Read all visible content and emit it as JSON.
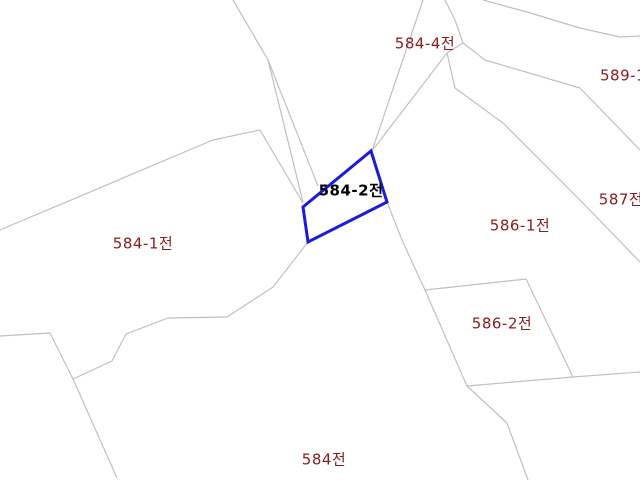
{
  "canvas": {
    "width": 640,
    "height": 480,
    "background": "#ffffff"
  },
  "map": {
    "type": "cadastral-parcel-map",
    "boundary_line_color": "#c0c0c0",
    "highlight_color": "#1b1bd9",
    "label_color": "#8b1a1a",
    "highlight_label_color": "#000000",
    "boundaries": [
      [
        [
          0,
          230
        ],
        [
          213,
          140
        ],
        [
          260,
          130
        ],
        [
          303,
          203
        ]
      ],
      [
        [
          233,
          0
        ],
        [
          268,
          60
        ],
        [
          303,
          202
        ]
      ],
      [
        [
          268,
          60
        ],
        [
          318,
          186
        ]
      ],
      [
        [
          423,
          0
        ],
        [
          372,
          151
        ]
      ],
      [
        [
          445,
          0
        ],
        [
          455,
          20
        ],
        [
          463,
          43
        ]
      ],
      [
        [
          463,
          43
        ],
        [
          447,
          53
        ]
      ],
      [
        [
          447,
          53
        ],
        [
          372,
          151
        ]
      ],
      [
        [
          447,
          53
        ],
        [
          455,
          88
        ],
        [
          503,
          123
        ],
        [
          580,
          200
        ],
        [
          640,
          262
        ]
      ],
      [
        [
          463,
          43
        ],
        [
          485,
          60
        ],
        [
          580,
          88
        ],
        [
          640,
          150
        ]
      ],
      [
        [
          483,
          0
        ],
        [
          527,
          12
        ],
        [
          580,
          28
        ],
        [
          620,
          37
        ],
        [
          640,
          36
        ]
      ],
      [
        [
          387,
          202
        ],
        [
          402,
          240
        ],
        [
          425,
          290
        ],
        [
          467,
          386
        ],
        [
          507,
          423
        ],
        [
          528,
          480
        ]
      ],
      [
        [
          425,
          290
        ],
        [
          526,
          279
        ]
      ],
      [
        [
          526,
          279
        ],
        [
          573,
          377
        ]
      ],
      [
        [
          467,
          386
        ],
        [
          573,
          377
        ],
        [
          640,
          372
        ]
      ],
      [
        [
          308,
          242
        ],
        [
          273,
          287
        ],
        [
          227,
          317
        ],
        [
          168,
          318
        ],
        [
          126,
          334
        ],
        [
          112,
          361
        ],
        [
          73,
          379
        ]
      ],
      [
        [
          0,
          336
        ],
        [
          50,
          333
        ],
        [
          73,
          379
        ],
        [
          117,
          478
        ]
      ]
    ],
    "highlighted_parcel": {
      "id": "584-2",
      "label": "584-2전",
      "points": [
        [
          371,
          151
        ],
        [
          387,
          202
        ],
        [
          308,
          242
        ],
        [
          303,
          207
        ]
      ]
    },
    "labels": [
      {
        "text": "584-4전",
        "x": 425,
        "y": 44,
        "anchor": "center",
        "highlighted": false
      },
      {
        "text": "589-1전",
        "x": 600,
        "y": 76,
        "anchor": "left",
        "highlighted": false
      },
      {
        "text": "587전",
        "x": 621,
        "y": 200,
        "anchor": "center",
        "highlighted": false
      },
      {
        "text": "586-1전",
        "x": 520,
        "y": 226,
        "anchor": "center",
        "highlighted": false
      },
      {
        "text": "586-2전",
        "x": 502,
        "y": 324,
        "anchor": "center",
        "highlighted": false
      },
      {
        "text": "584-1전",
        "x": 143,
        "y": 244,
        "anchor": "center",
        "highlighted": false
      },
      {
        "text": "584전",
        "x": 324,
        "y": 460,
        "anchor": "center",
        "highlighted": false
      },
      {
        "text": "584-2전",
        "x": 351,
        "y": 191,
        "anchor": "center",
        "highlighted": true
      }
    ]
  }
}
